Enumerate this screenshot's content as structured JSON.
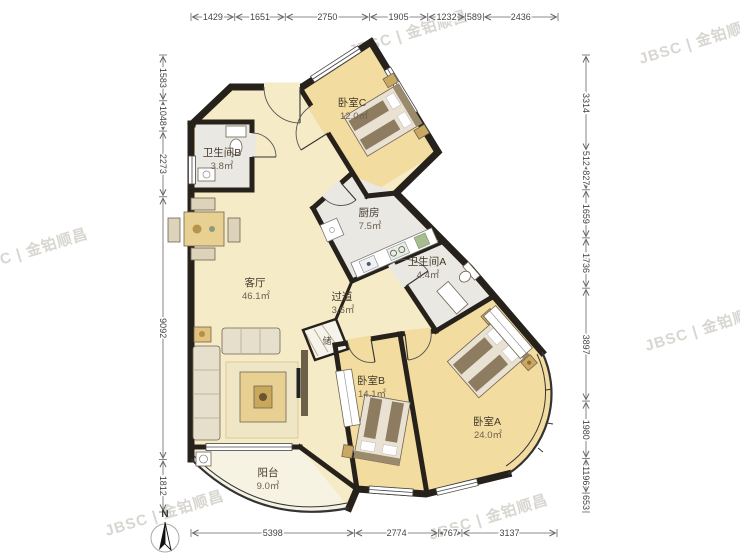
{
  "plan": {
    "rooms": [
      {
        "name": "卧室C",
        "area": "12.0㎡"
      },
      {
        "name": "卫生间B",
        "area": "3.8㎡"
      },
      {
        "name": "厨房",
        "area": "7.5㎡"
      },
      {
        "name": "卫生间A",
        "area": "4.4㎡"
      },
      {
        "name": "客厅",
        "area": "46.1㎡"
      },
      {
        "name": "过道",
        "area": "3.6㎡"
      },
      {
        "name": "储",
        "area": ""
      },
      {
        "name": "卧室B",
        "area": "14.1㎡"
      },
      {
        "name": "卧室A",
        "area": "24.0㎡"
      },
      {
        "name": "阳台",
        "area": "9.0㎡"
      }
    ],
    "dimensions": {
      "top": [
        "1429",
        "1651",
        "2750",
        "1905",
        "1232",
        "589",
        "2436"
      ],
      "bottom": [
        "5398",
        "2774",
        "767",
        "3137"
      ],
      "left": [
        "1583",
        "1048",
        "2273",
        "9092",
        "1812"
      ],
      "right": [
        "3314",
        "512",
        "827",
        "1659",
        "1736",
        "3897",
        "1980",
        "1196",
        "653"
      ]
    },
    "compass": "N",
    "watermark": "JBSC | 金铂顺昌"
  }
}
